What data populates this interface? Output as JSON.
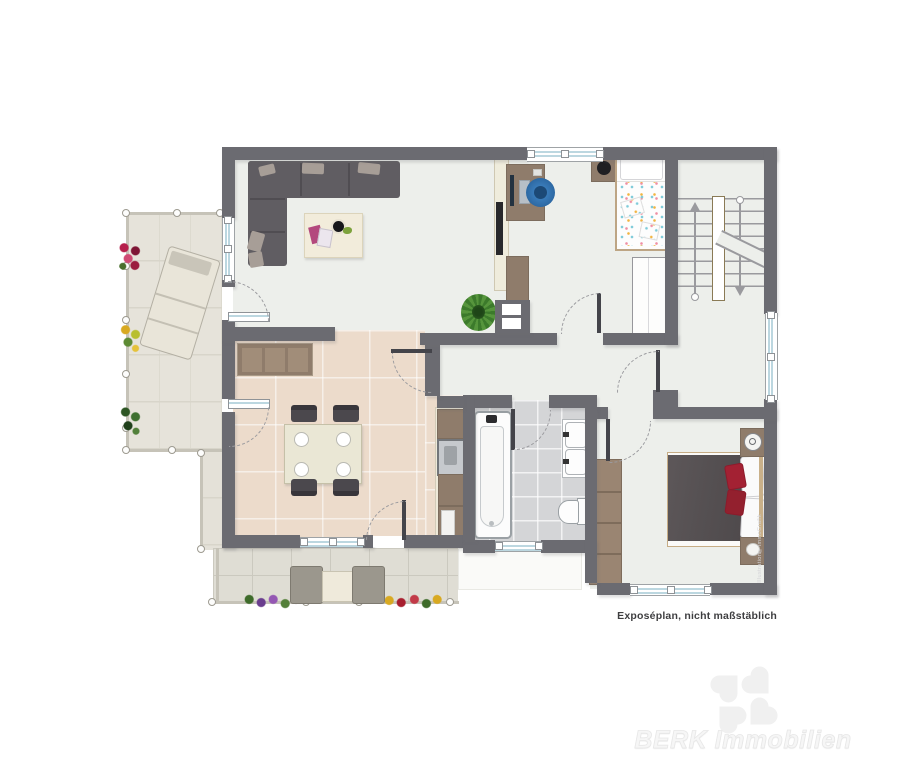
{
  "page": {
    "background": "#ffffff",
    "caption": "Exposéplan, nicht maßstäblich"
  },
  "watermark": {
    "brand_text": "BERK Immobilien",
    "logo_icon": "four-leaf-clover",
    "credit_vertical": "Illustration©ImmoGrafik"
  },
  "palette": {
    "wall": "#6b6b71",
    "floor_light": "#edefeb",
    "floor_kitchen": "#ecdbcb",
    "floor_bathroom": "#d4d5d7",
    "terrace_side": "#e6e3da",
    "terrace_lower": "#dfddd4",
    "glazing_blue": "#bcd7e0",
    "sofa_gray": "#605d62",
    "wood_brown": "#8f7c6b",
    "office_chair_blue": "#2f6fae",
    "bed_blanket_gray": "#585355",
    "cushion_red": "#a32133",
    "watermark_gray": "#f0f0f0"
  }
}
